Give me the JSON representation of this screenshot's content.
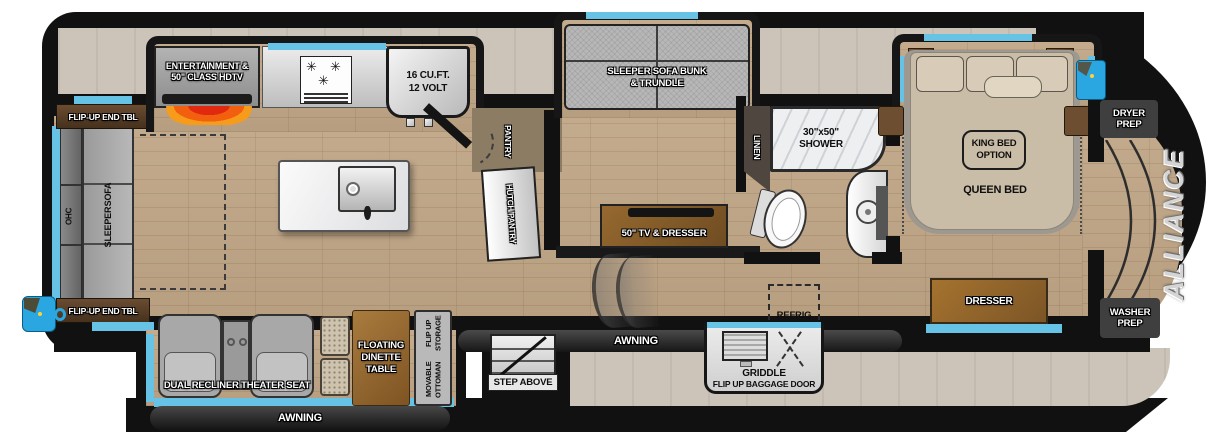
{
  "brand": "ALLIANCE",
  "colors": {
    "accent_blue": "#67c3e6",
    "body_black": "#111111",
    "floor_wood": "#c0a686",
    "band_beige": "#ccc4b9",
    "fireplace_orange": "#f2600f"
  },
  "rear": {
    "ohc": "OHC",
    "sleeper_sofa_line1": "SLEEPER",
    "sleeper_sofa_line2": "SOFA",
    "flip_up_end_table_top": "FLIP-UP END TBL",
    "flip_up_end_table_bottom": "FLIP-UP END TBL"
  },
  "kitchen": {
    "entertainment_line1": "ENTERTAINMENT &",
    "entertainment_line2": "50\" CLASS HDTV",
    "fridge_line1": "16 CU.FT.",
    "fridge_line2": "12 VOLT",
    "pantry": "PANTRY",
    "hutch_pantry": "HUTCH/PANTRY"
  },
  "bunk_room": {
    "sofa_line1": "SLEEPER SOFA BUNK",
    "sofa_line2": "& TRUNDLE",
    "tv_dresser": "50\" TV & DRESSER"
  },
  "bathroom": {
    "linen": "LINEN",
    "shower_line1": "30\"x50\"",
    "shower_line2": "SHOWER"
  },
  "bedroom": {
    "king_option_line1": "KING BED",
    "king_option_line2": "OPTION",
    "queen_bed": "QUEEN BED",
    "dresser": "DRESSER"
  },
  "front": {
    "dryer_line1": "DRYER",
    "dryer_line2": "PREP",
    "washer_line1": "WASHER",
    "washer_line2": "PREP"
  },
  "door_side": {
    "theater_seat": "DUAL RECLINER THEATER SEAT",
    "dinette_line1": "FLOATING",
    "dinette_line2": "DINETTE",
    "dinette_line3": "TABLE",
    "ottoman_line1": "MOVABLE OTTOMAN",
    "ottoman_line2": "FLIP UP STORAGE",
    "step_above": "STEP ABOVE",
    "awning_rear": "AWNING",
    "awning_main": "AWNING",
    "refrig": "REFRIG",
    "griddle_line1": "GRIDDLE",
    "griddle_line2": "FLIP UP BAGGAGE DOOR"
  }
}
